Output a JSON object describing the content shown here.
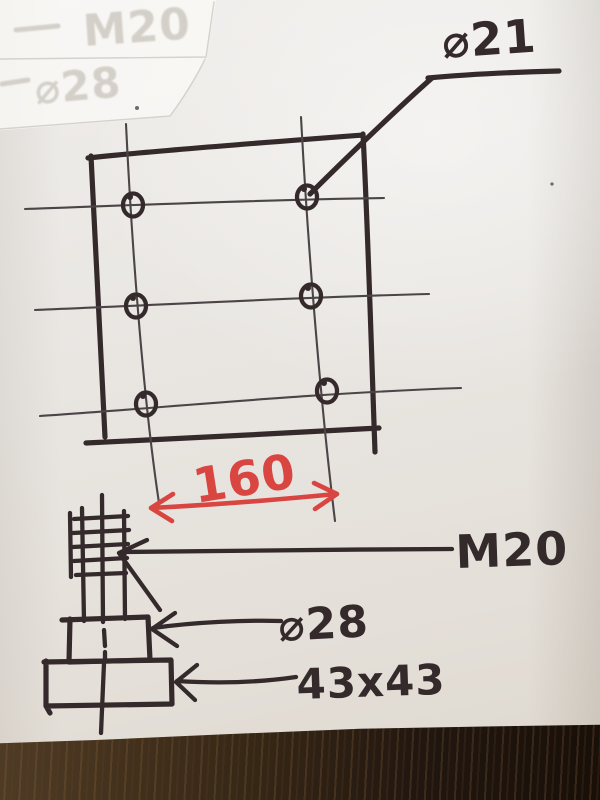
{
  "colors": {
    "ink": "#342a2c",
    "pen": "#4c4548",
    "red": "#d94540",
    "paper": "#e9e6e2",
    "table": "#342515"
  },
  "sketch": {
    "plate_view": {
      "hole_diameter_label": "⌀21",
      "width_dimension_label": "160",
      "hole_count": 6
    },
    "bolt_view": {
      "thread_label": "M20",
      "collar_diameter_label": "⌀28",
      "base_size_label": "43x43"
    },
    "faint_impressions": {
      "line1": "M20",
      "line2": "⌀28"
    }
  }
}
